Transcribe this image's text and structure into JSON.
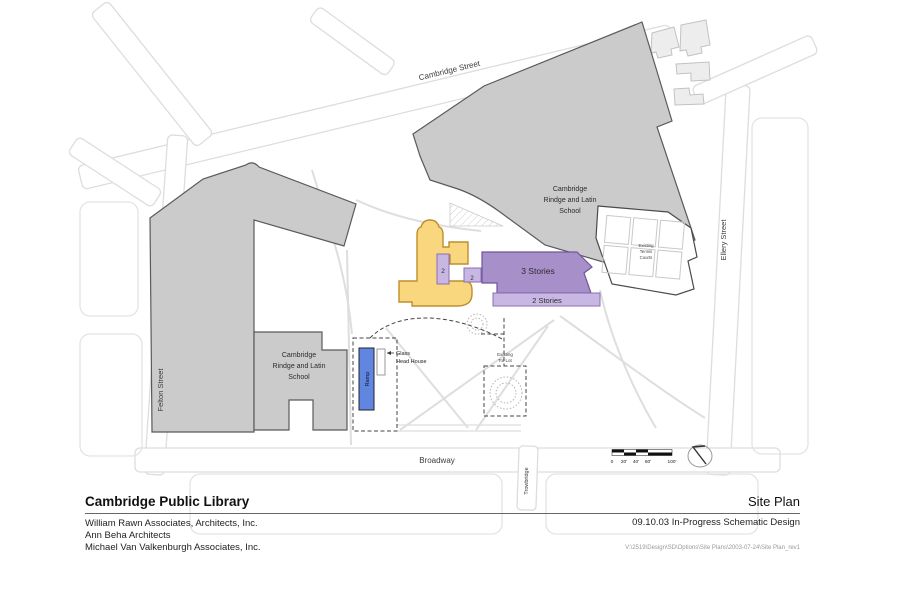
{
  "colors": {
    "existing_gray": "#CBCBCB",
    "neighbor_gray": "#EDEDED",
    "library_yellow": "#F8D77E",
    "addition_purple": "#A78FC9",
    "addition_light_purple": "#C9B7E3",
    "ramp_blue": "#6186E0"
  },
  "plan": {
    "streets": {
      "cambridge": "Cambridge Street",
      "felton": "Felton Street",
      "ellery": "Ellery Street",
      "broadway": "Broadway",
      "trowbridge": "Trowbridge"
    },
    "school": {
      "l1": "Cambridge",
      "l2": "Rindge and Latin",
      "l3": "School"
    },
    "floors_tower": "2",
    "floors_link": "2",
    "addition_main": "3 Stories",
    "addition_wing": "2 Stories",
    "ramp": "Ramp",
    "glass_l1": "Glass",
    "glass_l2": "Head House",
    "tennis_l1": "Existing",
    "tennis_l2": "Tennis",
    "tennis_l3": "Courts",
    "totlot_l1": "Existing",
    "totlot_l2": "Tot Lot",
    "scale": {
      "t0": "0",
      "t20": "20'",
      "t40": "40'",
      "t60": "60'",
      "t100": "100'"
    }
  },
  "title_block": {
    "project": "Cambridge Public Library",
    "architects": [
      "William Rawn Associates, Architects, Inc.",
      "Ann Beha Architects",
      "Michael Van Valkenburgh Associates, Inc."
    ],
    "sheet_title": "Site Plan",
    "issue": "09.10.03 In-Progress Schematic Design",
    "file_path": "V:\\2519\\Design\\SD\\Options\\Site Plans\\2003-07-24\\Site Plan_rev1"
  }
}
